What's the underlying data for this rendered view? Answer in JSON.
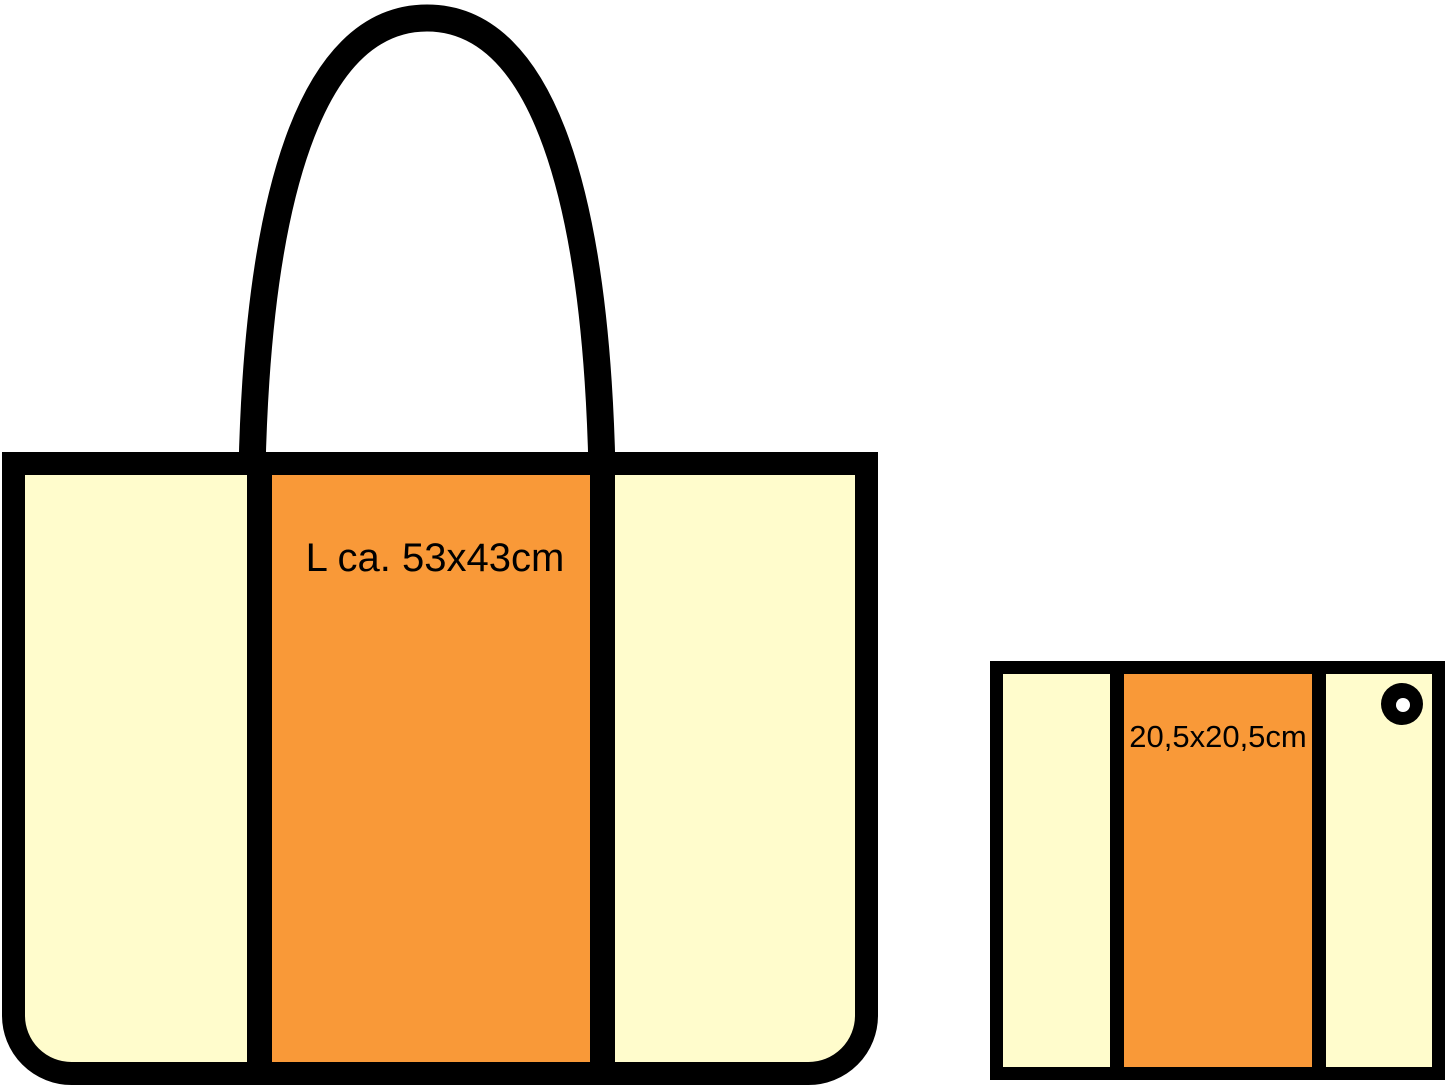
{
  "diagram": {
    "large_bag": {
      "dimension_label": "L ca. 53x43cm"
    },
    "small_bag": {
      "dimension_label": "20,5x20,5cm",
      "snap_button_icon": "press-stud"
    },
    "colors": {
      "cream": "#FFFCCC",
      "orange": "#F99938",
      "outline": "#000000",
      "snap_hole": "#FFFFFF",
      "background": "#FFFFFF"
    }
  }
}
